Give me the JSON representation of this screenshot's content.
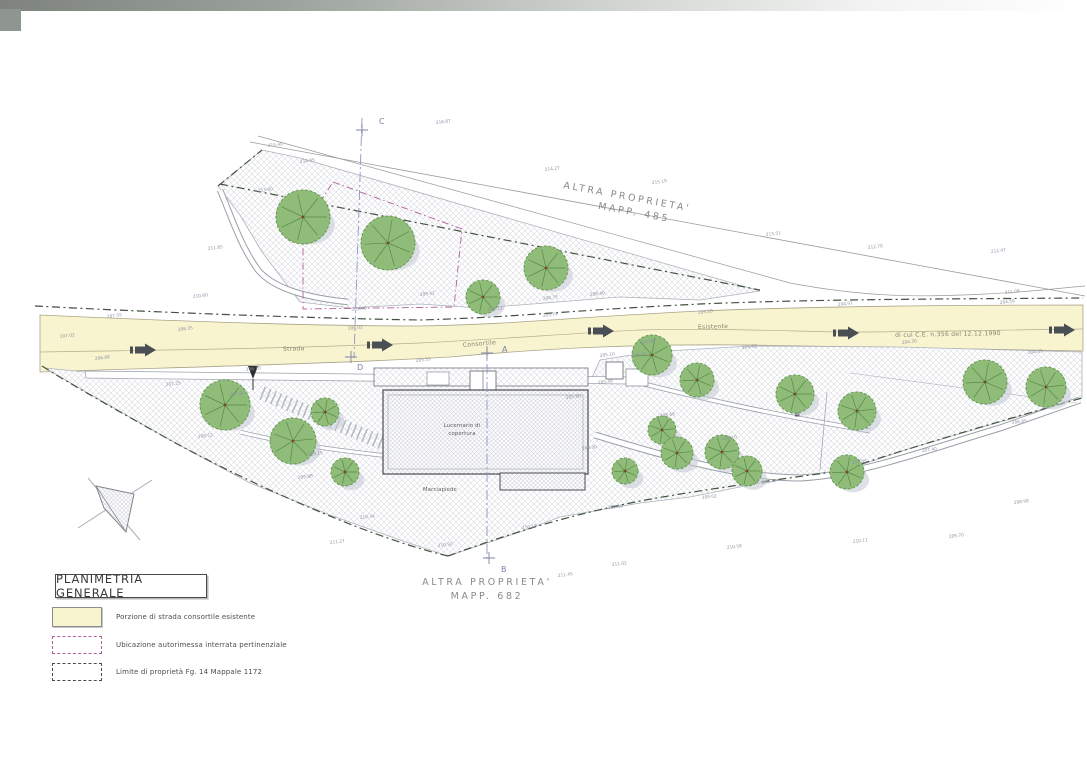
{
  "title_block": {
    "title": "PLANIMETRIA GENERALE"
  },
  "legend": {
    "items": [
      {
        "key": "road",
        "label": "Porzione di strada consortile esistente"
      },
      {
        "key": "garage",
        "label": "Ubicazione autorimessa interrata pertinenziale"
      },
      {
        "key": "boundary",
        "label": "Limite di proprietà Fg. 14 Mappale 1172"
      }
    ]
  },
  "plan": {
    "properties": {
      "north_label_line1": "ALTRA PROPRIETA'",
      "north_label_line2": "MAPP. 485",
      "south_label_line1": "ALTRA PROPRIETA'",
      "south_label_line2": "MAPP. 682"
    },
    "road": {
      "label_strada": "Strada",
      "label_consortile": "Consortile",
      "label_esistente": "Esistente",
      "label_ce": "di cui C.E. n.356 del 12.12.1990"
    },
    "building": {
      "label_line1": "Lucernario di",
      "label_line2": "copertura",
      "sidewalk_label": "Marciapiede"
    },
    "sections": {
      "c": "C",
      "d": "D",
      "a": "A",
      "b": "B"
    },
    "colors": {
      "road_fill": "#f8f4cf",
      "garage_dash": "#b0609a",
      "boundary_dash": "#41523f",
      "tree_fill": "#8fbc79",
      "section_line": "#8f94c6"
    },
    "trees": [
      {
        "x": 303,
        "y": 217,
        "r": 27
      },
      {
        "x": 388,
        "y": 243,
        "r": 27
      },
      {
        "x": 546,
        "y": 268,
        "r": 22
      },
      {
        "x": 483,
        "y": 297,
        "r": 17
      },
      {
        "x": 225,
        "y": 405,
        "r": 25
      },
      {
        "x": 293,
        "y": 441,
        "r": 23
      },
      {
        "x": 325,
        "y": 412,
        "r": 14
      },
      {
        "x": 345,
        "y": 472,
        "r": 14
      },
      {
        "x": 652,
        "y": 355,
        "r": 20
      },
      {
        "x": 697,
        "y": 380,
        "r": 17
      },
      {
        "x": 795,
        "y": 394,
        "r": 19
      },
      {
        "x": 857,
        "y": 411,
        "r": 19
      },
      {
        "x": 662,
        "y": 430,
        "r": 14
      },
      {
        "x": 677,
        "y": 453,
        "r": 16
      },
      {
        "x": 722,
        "y": 452,
        "r": 17
      },
      {
        "x": 747,
        "y": 471,
        "r": 15
      },
      {
        "x": 625,
        "y": 471,
        "r": 13
      },
      {
        "x": 847,
        "y": 472,
        "r": 17
      },
      {
        "x": 985,
        "y": 382,
        "r": 22
      },
      {
        "x": 1046,
        "y": 387,
        "r": 20
      }
    ],
    "spot_elevations": [
      {
        "x": 268,
        "y": 147,
        "v": "215.40"
      },
      {
        "x": 436,
        "y": 124,
        "v": "216.87"
      },
      {
        "x": 545,
        "y": 171,
        "v": "214.27"
      },
      {
        "x": 652,
        "y": 184,
        "v": "215.19"
      },
      {
        "x": 766,
        "y": 236,
        "v": "213.51"
      },
      {
        "x": 868,
        "y": 249,
        "v": "212.70"
      },
      {
        "x": 991,
        "y": 253,
        "v": "212.47"
      },
      {
        "x": 1005,
        "y": 294,
        "v": "211.08"
      },
      {
        "x": 300,
        "y": 163,
        "v": "214.95"
      },
      {
        "x": 258,
        "y": 192,
        "v": "213.60"
      },
      {
        "x": 420,
        "y": 296,
        "v": "209.42"
      },
      {
        "x": 543,
        "y": 300,
        "v": "208.75"
      },
      {
        "x": 590,
        "y": 296,
        "v": "208.40"
      },
      {
        "x": 488,
        "y": 311,
        "v": "208.12"
      },
      {
        "x": 352,
        "y": 311,
        "v": "208.90"
      },
      {
        "x": 178,
        "y": 331,
        "v": "206.35"
      },
      {
        "x": 348,
        "y": 330,
        "v": "206.02"
      },
      {
        "x": 543,
        "y": 317,
        "v": "205.74"
      },
      {
        "x": 698,
        "y": 314,
        "v": "205.28"
      },
      {
        "x": 838,
        "y": 306,
        "v": "204.91"
      },
      {
        "x": 1000,
        "y": 304,
        "v": "204.56"
      },
      {
        "x": 95,
        "y": 360,
        "v": "206.88"
      },
      {
        "x": 246,
        "y": 371,
        "v": "206.10"
      },
      {
        "x": 416,
        "y": 362,
        "v": "205.55"
      },
      {
        "x": 640,
        "y": 344,
        "v": "204.98"
      },
      {
        "x": 742,
        "y": 349,
        "v": "204.62"
      },
      {
        "x": 902,
        "y": 344,
        "v": "204.30"
      },
      {
        "x": 1028,
        "y": 354,
        "v": "204.05"
      },
      {
        "x": 166,
        "y": 386,
        "v": "207.25"
      },
      {
        "x": 230,
        "y": 396,
        "v": "207.80"
      },
      {
        "x": 308,
        "y": 456,
        "v": "209.15"
      },
      {
        "x": 360,
        "y": 519,
        "v": "210.34"
      },
      {
        "x": 438,
        "y": 547,
        "v": "210.92"
      },
      {
        "x": 522,
        "y": 529,
        "v": "210.18"
      },
      {
        "x": 608,
        "y": 509,
        "v": "209.66"
      },
      {
        "x": 702,
        "y": 499,
        "v": "209.02"
      },
      {
        "x": 762,
        "y": 484,
        "v": "208.47"
      },
      {
        "x": 852,
        "y": 464,
        "v": "207.95"
      },
      {
        "x": 922,
        "y": 452,
        "v": "207.40"
      },
      {
        "x": 1012,
        "y": 424,
        "v": "206.85"
      },
      {
        "x": 722,
        "y": 440,
        "v": "208.10"
      },
      {
        "x": 660,
        "y": 417,
        "v": "208.66"
      },
      {
        "x": 582,
        "y": 450,
        "v": "209.30"
      },
      {
        "x": 298,
        "y": 479,
        "v": "209.88"
      },
      {
        "x": 198,
        "y": 438,
        "v": "208.52"
      },
      {
        "x": 558,
        "y": 577,
        "v": "211.45"
      },
      {
        "x": 612,
        "y": 566,
        "v": "211.02"
      },
      {
        "x": 727,
        "y": 549,
        "v": "210.58"
      },
      {
        "x": 853,
        "y": 543,
        "v": "210.11"
      },
      {
        "x": 949,
        "y": 538,
        "v": "209.70"
      },
      {
        "x": 1014,
        "y": 504,
        "v": "208.98"
      },
      {
        "x": 330,
        "y": 544,
        "v": "211.27"
      },
      {
        "x": 600,
        "y": 357,
        "v": "205.10"
      },
      {
        "x": 632,
        "y": 357,
        "v": "205.02"
      },
      {
        "x": 598,
        "y": 384,
        "v": "205.48"
      },
      {
        "x": 566,
        "y": 399,
        "v": "205.80"
      },
      {
        "x": 193,
        "y": 298,
        "v": "210.60"
      },
      {
        "x": 208,
        "y": 250,
        "v": "211.85"
      },
      {
        "x": 107,
        "y": 318,
        "v": "207.55"
      },
      {
        "x": 60,
        "y": 338,
        "v": "207.02"
      }
    ]
  }
}
